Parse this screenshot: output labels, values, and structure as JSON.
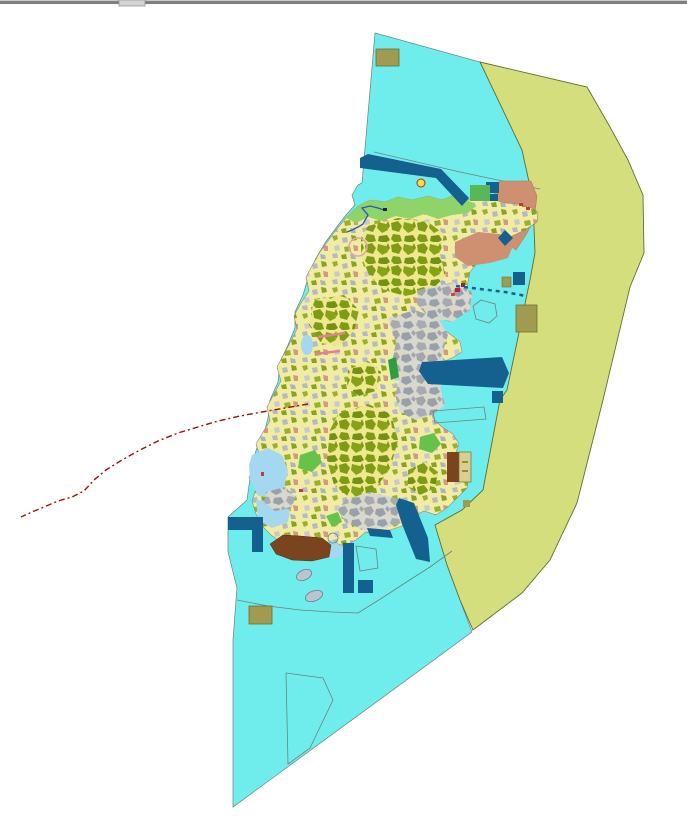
{
  "app": {
    "description_label": ""
  },
  "canvas": {
    "width": 687,
    "height": 821,
    "background": "#ffffff"
  },
  "palette": {
    "water_cyan": "#6feded",
    "outer_zone_green": "#d5de7d",
    "dark_blue": "#14608e",
    "land_outline": "#8a8a7a",
    "water_outline": "#6b8080",
    "zone_outline": "#5f6f33",
    "coast_green": "#8fd468",
    "tidal_blue": "#a4d7f0",
    "salmon": "#cf8f71",
    "brown": "#7a441e",
    "khaki": "#a19b51",
    "tan": "#d8cf90",
    "boundary_red": "#9e120a",
    "pink": "#e2828e",
    "stream_blue": "#2255cc"
  },
  "map": {
    "patterns": [
      {
        "id": "oliveMosaic",
        "width": 26,
        "height": 22,
        "bg": "#f0e88e",
        "cells": [
          {
            "pts": "1,3 8,1 12,6 9,12 2,10",
            "fill": "#7d9c13"
          },
          {
            "pts": "14,2 22,4 24,10 18,13 13,8",
            "fill": "#86a318"
          },
          {
            "pts": "3,14 10,15 12,21 5,23 1,19",
            "fill": "#7d9c13"
          },
          {
            "pts": "15,16 23,15 26,20 21,23 14,21",
            "fill": "#739214"
          },
          {
            "pts": "24,1 26,6 24,9 22,5",
            "fill": "#7d9c13"
          }
        ]
      },
      {
        "id": "grayMosaic",
        "width": 26,
        "height": 22,
        "bg": "#d8d8cf",
        "cells": [
          {
            "pts": "0,2 7,0 10,5 6,10 1,8",
            "fill": "#a3a5ad"
          },
          {
            "pts": "12,3 19,2 22,8 16,11 11,8",
            "fill": "#9aa0a8"
          },
          {
            "pts": "2,12 9,13 11,19 4,21 0,17",
            "fill": "#a8aab2"
          },
          {
            "pts": "14,14 21,13 24,18 19,21 13,19",
            "fill": "#9aa0a8"
          },
          {
            "pts": "23,0 26,3 24,6 21,3",
            "fill": "#a3a5ad"
          },
          {
            "pts": "10,0 12,1 11,3 9,2",
            "fill": "#e8e080"
          }
        ]
      },
      {
        "id": "mixedMosaic",
        "width": 30,
        "height": 26,
        "bg": "#f1eca3",
        "cells": [
          {
            "pts": "2,2 7,1 8,5 4,7",
            "fill": "#9ab02c"
          },
          {
            "pts": "12,4 17,3 18,8 13,9",
            "fill": "#b7b9c0"
          },
          {
            "pts": "21,1 26,2 27,6 22,7",
            "fill": "#8aa31e"
          },
          {
            "pts": "4,12 9,11 10,16 5,17",
            "fill": "#c8c9cf"
          },
          {
            "pts": "14,13 20,12 21,17 15,18",
            "fill": "#9ab02c"
          },
          {
            "pts": "23,11 28,12 28,17 24,17",
            "fill": "#d49a80"
          },
          {
            "pts": "2,20 7,19 8,24 3,24",
            "fill": "#b7b9c0"
          },
          {
            "pts": "11,21 16,20 17,25 12,25",
            "fill": "#8aa31e"
          },
          {
            "pts": "20,20 25,21 26,25 21,25",
            "fill": "#aab4c0"
          }
        ]
      }
    ],
    "layers": [
      {
        "type": "rect",
        "name": "window-top-border-highlight",
        "x": 0,
        "y": 0,
        "w": 687,
        "h": 1,
        "fill": "#c8c8c8"
      },
      {
        "type": "rect",
        "name": "window-top-border",
        "x": 0,
        "y": 1,
        "w": 687,
        "h": 3,
        "fill": "#7f7f7f"
      },
      {
        "type": "rect",
        "name": "window-resize-handle",
        "x": 119,
        "y": 0,
        "w": 26,
        "h": 6,
        "fill": "#d2d2d2",
        "stroke": "#9a9a9a",
        "sw": 0.8,
        "interactable": true
      },
      {
        "type": "polygon",
        "name": "water-region",
        "fill": "#6feded",
        "stroke": "#6b8080",
        "sw": 0.7,
        "points": "375,33 480,62 522,150 533,200 535,253 530,280 507,390 500,400 483,490 462,510 435,525 447,565 460,600 472,632 233,807 233,640 236,600 237,588 228,552 228,517 247,500 250,478 252,462 258,445 265,430 268,418 270,400 278,382 280,362 288,345 295,328 295,312 303,295 308,278 315,260 325,243 336,228 346,215 355,205 352,195 358,185 362,183"
      },
      {
        "type": "polygon",
        "name": "outer-zone-region",
        "fill": "#d5de7d",
        "stroke": "#5f6f33",
        "sw": 0.9,
        "points": "480,62 587,87 610,127 628,160 643,195 644,253 630,287 603,400 577,503 550,560 522,593 473,630 460,600 447,565 435,525 462,510 483,490 500,400 507,390 530,280 535,253 533,200 522,150"
      },
      {
        "type": "polyline",
        "name": "water-boundary-line-north",
        "stroke": "#6b8080",
        "sw": 0.7,
        "points": "374,152 460,172 540,189"
      },
      {
        "type": "polyline",
        "name": "water-boundary-line-south",
        "stroke": "#6b8080",
        "sw": 0.8,
        "points": "237,600 268,606 300,610 332,612 358,613 382,598 405,583 430,567 452,551"
      },
      {
        "type": "polygon",
        "name": "ne-salmon-zone",
        "fill": "#cf8f71",
        "stroke": "#b07055",
        "sw": 0.5,
        "points": "500,181 531,181 537,196 534,220 526,235 516,250 505,242 496,230 490,214 493,198"
      },
      {
        "type": "polygon",
        "name": "landmass",
        "fill": "pattern:mixedMosaic",
        "stroke": "#8a8a7a",
        "sw": 0.6,
        "points": "346,218 358,206 370,200 385,202 398,197 412,200 428,196 442,200 455,195 468,200 480,196 492,199 505,203 518,204 530,207 538,212 537,222 525,230 512,236 500,244 488,252 478,262 470,272 467,287 458,294 446,299 436,305 432,315 438,326 450,334 460,342 462,352 452,358 440,363 433,372 431,384 436,396 430,406 433,418 442,427 453,434 459,444 455,455 461,466 469,475 467,488 458,497 448,507 436,515 424,511 412,517 402,526 390,530 378,536 366,532 356,540 344,546 332,542 320,547 308,552 295,549 282,543 271,535 262,526 256,514 252,501 256,489 249,478 253,466 260,456 256,444 263,432 270,421 267,407 274,394 281,381 277,367 284,354 291,341 297,329 294,316 301,303 309,291 306,277 313,264 320,252 328,241 336,230"
      },
      {
        "type": "polygon",
        "name": "north-coast-green-band",
        "fill": "#8fd468",
        "points": "346,218 358,206 370,200 385,202 398,197 412,200 428,196 442,200 455,195 468,200 476,206 468,213 452,215 438,219 424,214 410,219 396,216 382,221 368,217 356,223"
      },
      {
        "type": "polygon",
        "name": "tidal-flat-west-1",
        "fill": "#a4d7f0",
        "points": "252,455 268,448 282,455 288,470 284,488 272,498 258,496 250,480 249,465"
      },
      {
        "type": "polygon",
        "name": "tidal-flat-west-2",
        "fill": "#a4d7f0",
        "points": "256,500 275,502 290,510 288,522 272,528 258,520"
      },
      {
        "type": "ellipse",
        "name": "tidal-flat-west-3",
        "cx": 307,
        "cy": 345,
        "rx": 6,
        "ry": 10,
        "fill": "#a4d7f0"
      },
      {
        "type": "polygon",
        "name": "south-lagoon",
        "fill": "#a4d7f0",
        "points": "316,545 332,540 344,548 340,558 324,558"
      },
      {
        "type": "polygon",
        "name": "olive-parcel-cluster-north",
        "fill": "pattern:oliveMosaic",
        "points": "368,226 398,218 428,222 444,234 440,256 446,276 430,291 405,296 384,290 369,275 361,255 361,238"
      },
      {
        "type": "polygon",
        "name": "olive-parcel-cluster-west",
        "fill": "pattern:oliveMosaic",
        "points": "314,300 344,295 359,310 354,331 339,346 321,343 309,325"
      },
      {
        "type": "polygon",
        "name": "olive-parcel-cluster-south",
        "fill": "pattern:oliveMosaic",
        "points": "330,430 338,414 368,404 391,414 398,440 390,470 372,492 350,498 334,485 327,460"
      },
      {
        "type": "polygon",
        "name": "olive-parcel-cluster-se",
        "fill": "pattern:oliveMosaic",
        "points": "408,470 425,462 438,472 435,488 420,495 408,487"
      },
      {
        "type": "polygon",
        "name": "olive-parcel-cluster-mid",
        "fill": "pattern:oliveMosaic",
        "points": "348,370 368,361 381,372 376,391 359,396 347,386"
      },
      {
        "type": "polygon",
        "name": "urban-gray-zone-ne",
        "fill": "pattern:grayMosaic",
        "points": "418,290 455,282 472,292 470,310 452,322 430,318 417,305"
      },
      {
        "type": "polygon",
        "name": "urban-gray-zone-center",
        "fill": "pattern:grayMosaic",
        "points": "388,318 415,310 438,318 448,335 442,355 448,372 440,388 445,405 432,415 415,420 400,412 395,395 400,378 392,362 396,342"
      },
      {
        "type": "polygon",
        "name": "urban-gray-zone-south",
        "fill": "pattern:grayMosaic",
        "points": "345,500 370,492 395,498 415,505 420,515 405,522 385,528 362,530 345,522 338,510"
      },
      {
        "type": "polygon",
        "name": "urban-gray-zone-west",
        "fill": "pattern:grayMosaic",
        "points": "266,492 285,487 296,497 291,508 275,511 264,502"
      },
      {
        "type": "polygon",
        "name": "salmon-band-ne",
        "fill": "#cf8f71",
        "points": "455,242 478,232 500,234 513,246 508,258 490,263 468,266 455,257"
      },
      {
        "type": "polygon",
        "name": "green-patch-1",
        "fill": "#2f9e3f",
        "points": "388,360 396,357 399,377 391,380"
      },
      {
        "type": "polygon",
        "name": "green-patch-2",
        "fill": "#66c24a",
        "points": "300,455 315,450 322,462 312,472 298,468"
      },
      {
        "type": "polygon",
        "name": "green-patch-3",
        "fill": "#66c24a",
        "points": "420,437 434,433 441,444 432,453 419,449"
      },
      {
        "type": "polygon",
        "name": "green-patch-4",
        "fill": "#66c24a",
        "points": "326,516 338,512 342,522 332,527"
      },
      {
        "type": "polyline",
        "name": "stream-line",
        "stroke": "#2255cc",
        "sw": 1.3,
        "points": "347,232 352,230 358,227 363,224 368,215 362,208 370,206 378,208 384,210"
      },
      {
        "type": "rect",
        "name": "stream-mouth-dot",
        "x": 383,
        "y": 208,
        "w": 4,
        "h": 3,
        "fill": "#202060"
      },
      {
        "type": "circle",
        "name": "hatched-circle-feature",
        "cx": 358,
        "cy": 247,
        "r": 9,
        "fill": "none",
        "stroke": "#dba7b0",
        "sw": 1.5
      },
      {
        "type": "circle",
        "name": "point-marker-yellow",
        "cx": 421,
        "cy": 183,
        "r": 4,
        "fill": "#f2e23e",
        "stroke": "#cc2222",
        "sw": 1
      },
      {
        "type": "rect",
        "name": "red-speck-1",
        "x": 455,
        "y": 288,
        "w": 5,
        "h": 4,
        "fill": "#c81832"
      },
      {
        "type": "rect",
        "name": "red-speck-2",
        "x": 461,
        "y": 283,
        "w": 4,
        "h": 4,
        "fill": "#8f1e5a"
      },
      {
        "type": "rect",
        "name": "red-speck-3",
        "x": 451,
        "y": 293,
        "w": 4,
        "h": 3,
        "fill": "#d24545"
      },
      {
        "type": "rect",
        "name": "red-speck-4",
        "x": 519,
        "y": 203,
        "w": 4,
        "h": 3,
        "fill": "#cc3333"
      },
      {
        "type": "rect",
        "name": "red-speck-5",
        "x": 526,
        "y": 207,
        "w": 4,
        "h": 3,
        "fill": "#cc3333"
      },
      {
        "type": "rect",
        "name": "red-speck-6",
        "x": 261,
        "y": 472,
        "w": 3,
        "h": 4,
        "fill": "#cc3344"
      },
      {
        "type": "rect",
        "name": "red-speck-7",
        "x": 299,
        "y": 489,
        "w": 4,
        "h": 3,
        "fill": "#cc3344"
      },
      {
        "type": "polyline",
        "name": "pink-line-1",
        "stroke": "#e2828e",
        "sw": 2.5,
        "points": "318,337 345,333"
      },
      {
        "type": "polyline",
        "name": "pink-line-2",
        "stroke": "#e2828e",
        "sw": 2.5,
        "points": "315,354 340,351"
      },
      {
        "type": "polygon",
        "name": "darkblue-band-north",
        "fill": "#14608e",
        "points": "360,158 368,154 441,169 469,198 462,206 436,178 360,168"
      },
      {
        "type": "rect",
        "name": "darkblue-square-1",
        "x": 486,
        "y": 182,
        "w": 13,
        "h": 11,
        "fill": "#14608e"
      },
      {
        "type": "rect",
        "name": "darkblue-square-2",
        "x": 490,
        "y": 194,
        "w": 8,
        "h": 7,
        "fill": "#14608e"
      },
      {
        "type": "rect",
        "name": "green-rect-ne",
        "x": 470,
        "y": 185,
        "w": 20,
        "h": 16,
        "fill": "#58b858"
      },
      {
        "type": "rect",
        "name": "darkblue-square-3",
        "x": 513,
        "y": 272,
        "w": 12,
        "h": 13,
        "fill": "#14608e"
      },
      {
        "type": "polygon",
        "name": "darkblue-diamond",
        "fill": "#14608e",
        "points": "498,238 505,230 513,238 505,246"
      },
      {
        "type": "rect",
        "name": "darkblue-square-4",
        "x": 492,
        "y": 391,
        "w": 11,
        "h": 12,
        "fill": "#14608e"
      },
      {
        "type": "polyline",
        "name": "darkblue-dashed-line",
        "stroke": "#14608e",
        "sw": 2.5,
        "dash": "4,4",
        "points": "456,286 480,289 505,292 526,296"
      },
      {
        "type": "polygon",
        "name": "darkblue-harbor-band",
        "fill": "#14608e",
        "points": "422,362 502,357 509,373 503,388 428,384 419,371"
      },
      {
        "type": "polygon",
        "name": "darkblue-band-se",
        "fill": "#14608e",
        "points": "399,498 414,503 428,538 430,562 416,559 402,524 396,505"
      },
      {
        "type": "rect",
        "name": "darkblue-band-south",
        "x": 343,
        "y": 543,
        "w": 11,
        "h": 50,
        "fill": "#14608e"
      },
      {
        "type": "polygon",
        "name": "darkblue-lshape-west",
        "fill": "#14608e",
        "points": "228,517 263,517 263,552 252,552 252,530 228,530"
      },
      {
        "type": "polygon",
        "name": "darkblue-wedge-south",
        "fill": "#14608e",
        "points": "367,528 390,530 393,538 370,536"
      },
      {
        "type": "rect",
        "name": "darkblue-square-5",
        "x": 358,
        "y": 580,
        "w": 15,
        "h": 13,
        "fill": "#14608e"
      },
      {
        "type": "rect",
        "name": "khaki-rect-top",
        "x": 376,
        "y": 49,
        "w": 23,
        "h": 17,
        "fill": "#a19b51",
        "stroke": "#6f6f2f",
        "sw": 0.8
      },
      {
        "type": "rect",
        "name": "khaki-rect-east",
        "x": 516,
        "y": 305,
        "w": 21,
        "h": 27,
        "fill": "#a19b51",
        "stroke": "#6f6f2f",
        "sw": 0.8
      },
      {
        "type": "rect",
        "name": "khaki-rect-small",
        "x": 502,
        "y": 277,
        "w": 9,
        "h": 10,
        "fill": "#a19b51",
        "stroke": "#6f6f2f",
        "sw": 0.6
      },
      {
        "type": "rect",
        "name": "khaki-rect-bottom",
        "x": 249,
        "y": 606,
        "w": 23,
        "h": 18,
        "fill": "#a19b51",
        "stroke": "#6f6f2f",
        "sw": 0.8
      },
      {
        "type": "rect",
        "name": "khaki-dot",
        "x": 463,
        "y": 500,
        "w": 7,
        "h": 7,
        "fill": "#a19b51"
      },
      {
        "type": "polygon",
        "name": "brown-zone-south",
        "fill": "#7a441e",
        "stroke": "#4f2c10",
        "sw": 0.5,
        "points": "270,544 283,535 300,536 322,538 331,545 329,557 312,561 292,560 276,554"
      },
      {
        "type": "rect",
        "name": "brown-block-east",
        "x": 447,
        "y": 452,
        "w": 12,
        "h": 30,
        "fill": "#7a441e"
      },
      {
        "type": "rect",
        "name": "tan-block-east",
        "x": 459,
        "y": 452,
        "w": 12,
        "h": 30,
        "fill": "#d8cf90",
        "stroke": "#6f6f2f",
        "sw": 0.7
      },
      {
        "type": "rect",
        "name": "tan-block-mark-1",
        "x": 462,
        "y": 461,
        "w": 6,
        "h": 2,
        "fill": "#9a8a40"
      },
      {
        "type": "rect",
        "name": "tan-block-mark-2",
        "x": 462,
        "y": 470,
        "w": 6,
        "h": 2,
        "fill": "#9a8a40"
      },
      {
        "type": "polygon",
        "name": "outline-parcel-hexagon",
        "fill": "none",
        "stroke": "#708080",
        "sw": 0.8,
        "points": "481,300 495,304 497,316 489,323 476,319 473,306"
      },
      {
        "type": "polygon",
        "name": "outline-parcel-rect",
        "fill": "none",
        "stroke": "#708080",
        "sw": 0.8,
        "points": "433,411 484,407 486,419 435,423"
      },
      {
        "type": "polygon",
        "name": "outline-parcel-trapezoid",
        "fill": "none",
        "stroke": "#708080",
        "sw": 0.8,
        "points": "286,673 323,678 333,700 310,748 288,764"
      },
      {
        "type": "polygon",
        "name": "outline-parcel-quad",
        "fill": "none",
        "stroke": "#708080",
        "sw": 0.8,
        "points": "356,546 376,549 378,568 360,571"
      },
      {
        "type": "circle",
        "name": "outline-circle-coast",
        "cx": 333,
        "cy": 538,
        "r": 5,
        "fill": "none",
        "stroke": "#708080",
        "sw": 0.8
      },
      {
        "type": "ellipse",
        "name": "islet-1",
        "cx": 304,
        "cy": 575,
        "rx": 8,
        "ry": 5,
        "rot": -25,
        "fill": "#b9c6cd",
        "stroke": "#6b7b8b",
        "sw": 0.8
      },
      {
        "type": "ellipse",
        "name": "islet-2",
        "cx": 314,
        "cy": 596,
        "rx": 9,
        "ry": 5,
        "rot": -20,
        "fill": "#b9c6cd",
        "stroke": "#6b7b8b",
        "sw": 0.8
      },
      {
        "type": "polyline",
        "name": "red-dashed-boundary-line",
        "stroke": "#9e120a",
        "sw": 1.4,
        "dash": "6,3,2,3",
        "points": "308,404 285,408 262,412 240,416 218,421 198,427 178,433 158,441 140,450 122,460 106,470 94,480 84,491 72,497 58,501 44,507 32,512 21,517"
      }
    ]
  }
}
